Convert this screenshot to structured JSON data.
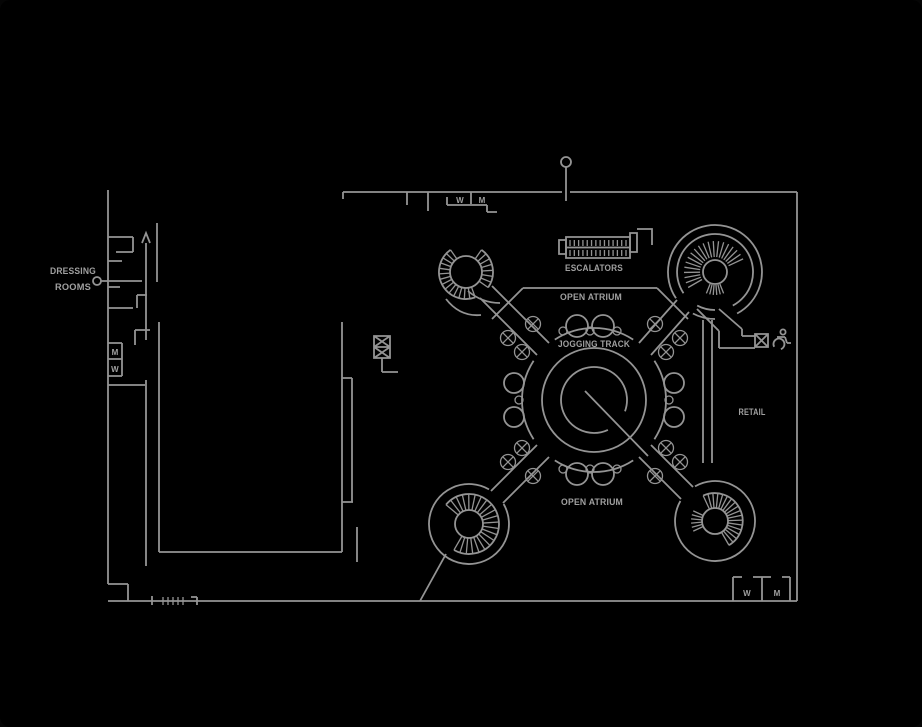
{
  "colors": {
    "background": "#000000",
    "line": "#949494",
    "text": "#a0a0a0"
  },
  "labels": {
    "dressing_rooms_line1": "DRESSING",
    "dressing_rooms_line2": "ROOMS",
    "restroom_top_w": "W",
    "restroom_top_m": "M",
    "restroom_left_m": "M",
    "restroom_left_w": "W",
    "escalators": "ESCALATORS",
    "open_atrium_top": "OPEN ATRIUM",
    "jogging_track": "JOGGING TRACK",
    "open_atrium_bottom": "OPEN ATRIUM",
    "retail": "RETAIL",
    "restroom_bottom_right_w": "W",
    "restroom_bottom_right_m": "M"
  }
}
